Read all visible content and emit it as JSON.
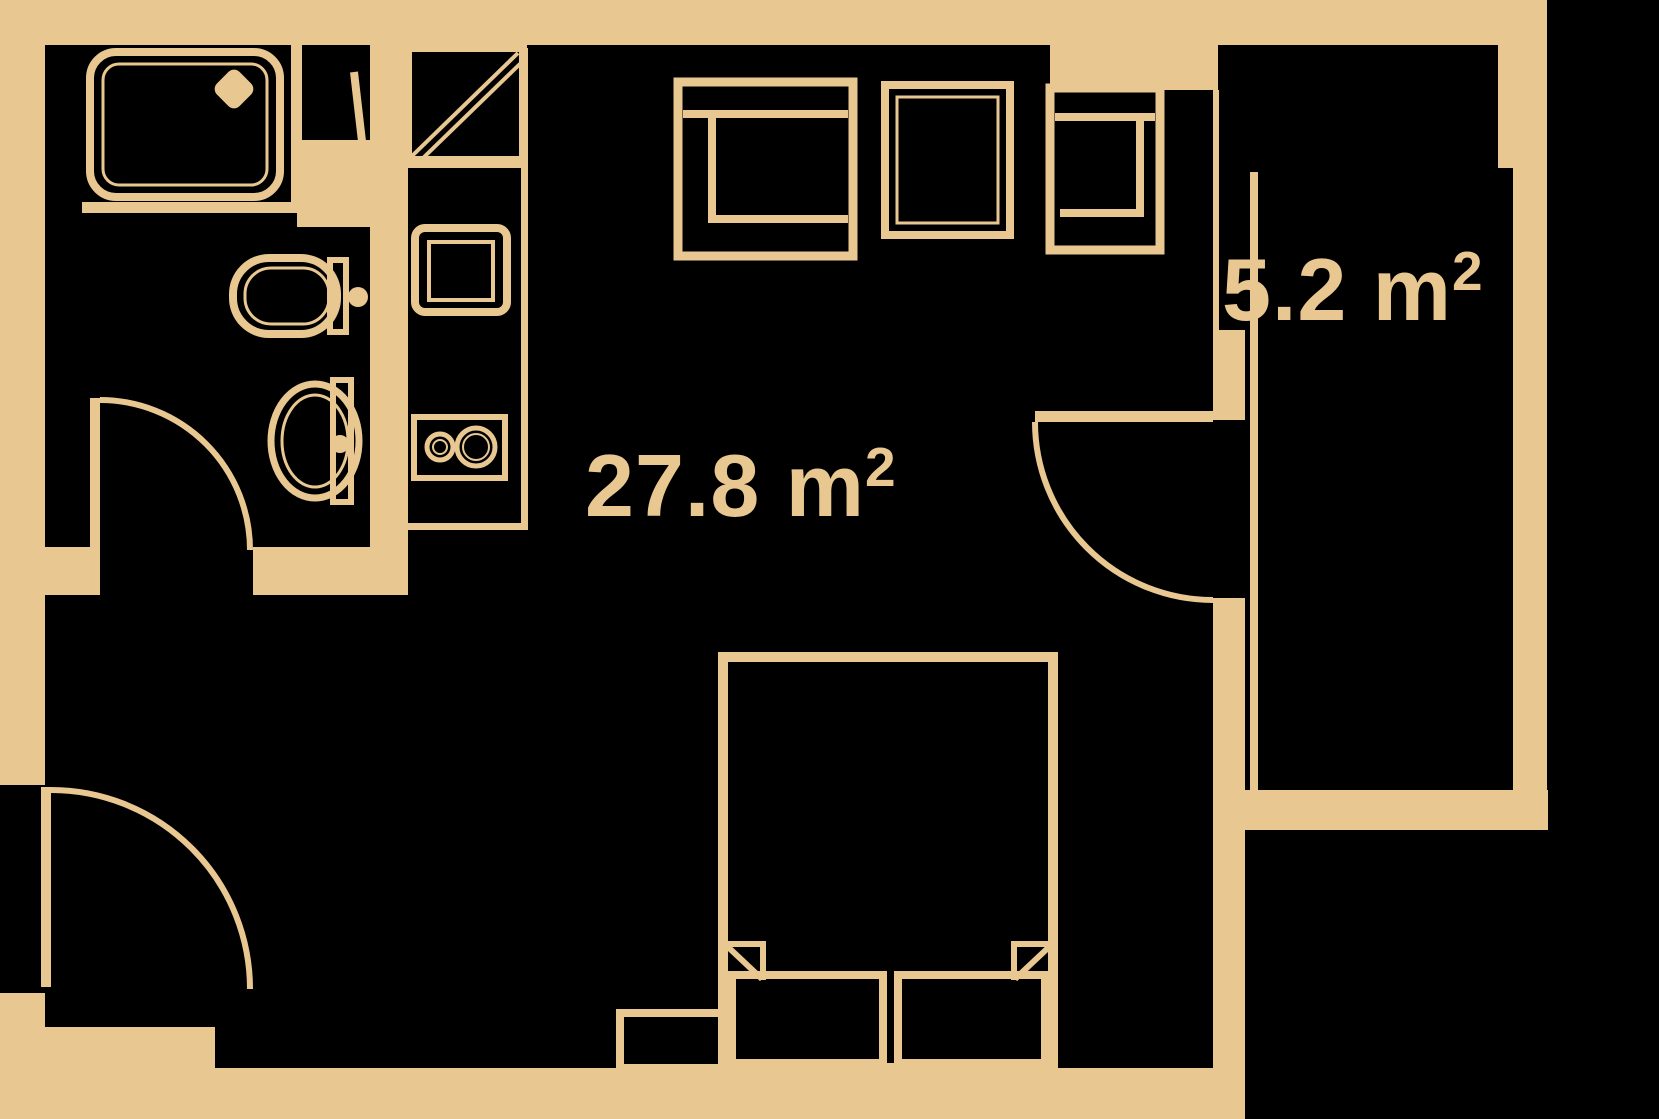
{
  "plan": {
    "title": "studio-apartment-floor-plan",
    "rooms": {
      "main": {
        "label": "27.8 m",
        "sup": "2",
        "area": "27.8 m²"
      },
      "balcony": {
        "label": "5.2 m",
        "sup": "2",
        "area": "5.2 m²"
      }
    },
    "colors": {
      "wall": "#E8C791",
      "background": "#000000"
    },
    "fixtures": [
      "shower-tray",
      "shower-drain",
      "shower-door",
      "toilet",
      "toilet-flush-button",
      "bathroom-sink",
      "fridge",
      "kitchen-sink",
      "cooktop",
      "armchair-left",
      "side-table",
      "armchair-right",
      "double-bed",
      "pillow-left",
      "pillow-right",
      "nightstand",
      "entry-door",
      "bathroom-door",
      "balcony-door"
    ]
  }
}
